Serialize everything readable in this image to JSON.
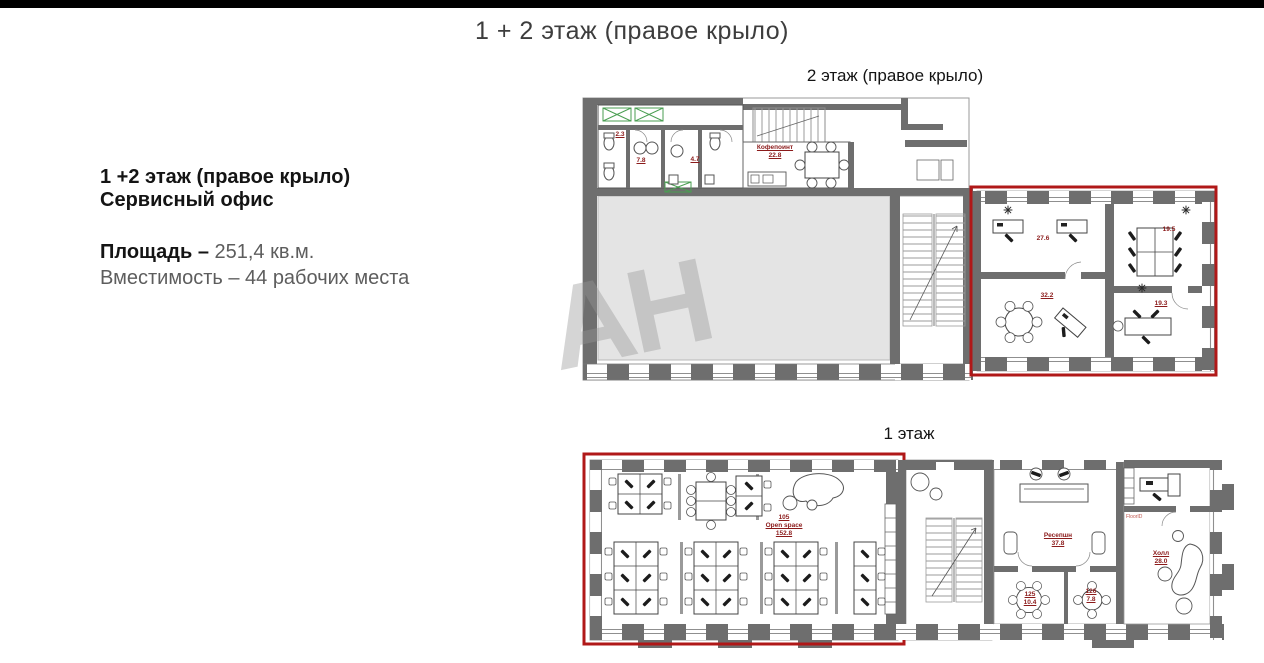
{
  "page": {
    "title": "1 + 2 этаж (правое крыло)"
  },
  "info": {
    "title_line1": "1 +2 этаж (правое крыло)",
    "title_line2": "Сервисный офис",
    "area_label": "Площадь –",
    "area_value": " 251,4 кв.м.",
    "capacity_line": "Вместимость – 44 рабочих места"
  },
  "watermark": {
    "text": "АН"
  },
  "colors": {
    "highlight_red": "#b01818",
    "wall_gray": "#6e6e6e",
    "room_fill": "#e4e4e4",
    "label_red": "#8b1a1a"
  },
  "floor2": {
    "heading": "2 этаж (правое крыло)",
    "labels": {
      "wc_small": "2.3",
      "wc_left": "7.8",
      "wc_right": "4.7",
      "coffee_name": "Кофепоинт",
      "coffee_area": "22.8",
      "office_a": "27.6",
      "office_b": "19.5",
      "office_c": "32.2",
      "office_d": "19.3"
    }
  },
  "floor1": {
    "heading": "1 этаж",
    "labels": {
      "openspace_num": "105",
      "openspace_name": "Open space",
      "openspace_area": "152.8",
      "reception_name": "Ресепшн",
      "reception_area": "37.8",
      "room125_num": "125",
      "room125_area": "10.4",
      "room126_num": "126",
      "room126_area": "7.8",
      "hall_name": "Холл",
      "hall_area": "28.0",
      "floor_id": "FloorID"
    }
  }
}
